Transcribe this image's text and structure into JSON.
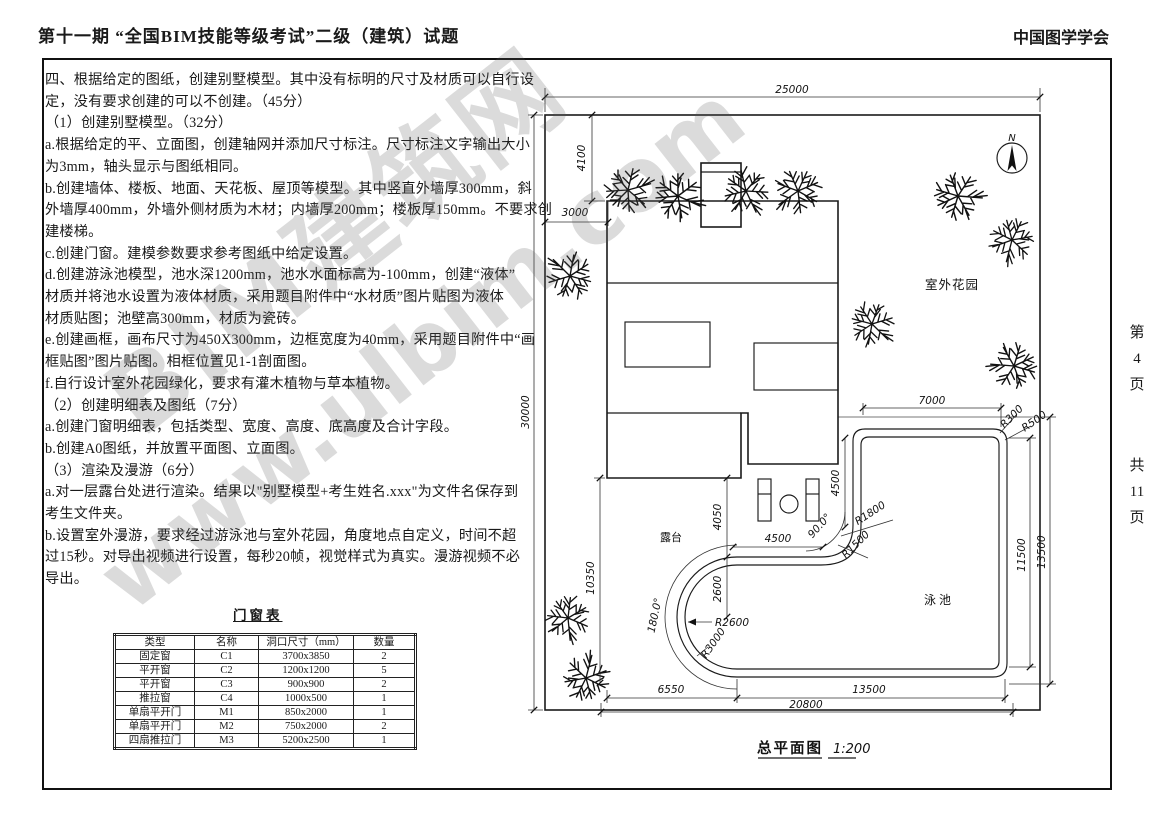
{
  "header": {
    "title": "第十一期 “全国BIM技能等级考试”二级（建筑）试题",
    "organization": "中国图学学会"
  },
  "page_margin": {
    "current": [
      "第",
      "4",
      "页"
    ],
    "total": [
      "共",
      "11",
      "页"
    ]
  },
  "watermark": {
    "line1": "BIM建筑网",
    "line2": "www.ulbim.com"
  },
  "question": {
    "lines": [
      "四、根据给定的图纸，创建别墅模型。其中没有标明的尺寸及材质可以自行设",
      "定，没有要求创建的可以不创建。（45分）",
      "（1）创建别墅模型。（32分）",
      "a.根据给定的平、立面图，创建轴网并添加尺寸标注。尺寸标注文字输出大小",
      "为3mm，轴头显示与图纸相同。",
      "b.创建墙体、楼板、地面、天花板、屋顶等模型。其中竖直外墙厚300mm，斜",
      "外墙厚400mm，外墙外侧材质为木材；内墙厚200mm；楼板厚150mm。不要求创",
      "建楼梯。",
      "c.创建门窗。建模参数要求参考图纸中给定设置。",
      "d.创建游泳池模型，池水深1200mm，池水水面标高为-100mm，创建“液体”",
      "材质并将池水设置为液体材质，采用题目附件中“水材质”图片贴图为液体",
      "材质贴图；池壁高300mm，材质为瓷砖。",
      "e.创建画框，画布尺寸为450X300mm，边框宽度为40mm，采用题目附件中“画",
      "框贴图”图片贴图。相框位置见1-1剖面图。",
      "f.自行设计室外花园绿化，要求有灌木植物与草本植物。",
      "（2）创建明细表及图纸（7分）",
      "a.创建门窗明细表，包括类型、宽度、高度、底高度及合计字段。",
      "b.创建A0图纸，并放置平面图、立面图。",
      "（3）渲染及漫游（6分）",
      "a.对一层露台处进行渲染。结果以\"别墅模型+考生姓名.xxx\"为文件名保存到",
      "考生文件夹。",
      "b.设置室外漫游，要求经过游泳池与室外花园，角度地点自定义，时间不超",
      "过15秒。对导出视频进行设置，每秒20帧，视觉样式为真实。漫游视频不必",
      "导出。"
    ]
  },
  "schedule_table": {
    "title": "门窗表",
    "headers": [
      "类型",
      "名称",
      "洞口尺寸（mm）",
      "数量"
    ],
    "rows": [
      [
        "固定窗",
        "C1",
        "3700x3850",
        "2"
      ],
      [
        "平开窗",
        "C2",
        "1200x1200",
        "5"
      ],
      [
        "平开窗",
        "C3",
        "900x900",
        "2"
      ],
      [
        "推拉窗",
        "C4",
        "1000x500",
        "1"
      ],
      [
        "单扇平开门",
        "M1",
        "850x2000",
        "1"
      ],
      [
        "单扇平开门",
        "M2",
        "750x2000",
        "2"
      ],
      [
        "四扇推拉门",
        "M3",
        "5200x2500",
        "1"
      ]
    ]
  },
  "drawing": {
    "title": "总平面图",
    "scale": "1:200",
    "labels": {
      "garden": "室外花园",
      "terrace": "露台",
      "pool": "泳池",
      "north": "N"
    },
    "dims": {
      "site_width": "25000",
      "site_height": "30000",
      "top_offset": "4100",
      "left_offset": "3000",
      "left_lower": "10350",
      "pool_top": "7000",
      "r300": "R300",
      "r500": "R500",
      "v4500": "4500",
      "h4500": "4500",
      "v4050": "4050",
      "v2600": "2600",
      "angle90": "90.0°",
      "r1800": "R1800",
      "r1500": "R1500",
      "right_11500": "11500",
      "right_13500": "13500",
      "r2600": "R2600",
      "r3000": "R3000",
      "angle180": "180.0°",
      "bottom_6550": "6550",
      "bottom_13500": "13500",
      "bottom_total": "20800"
    }
  }
}
